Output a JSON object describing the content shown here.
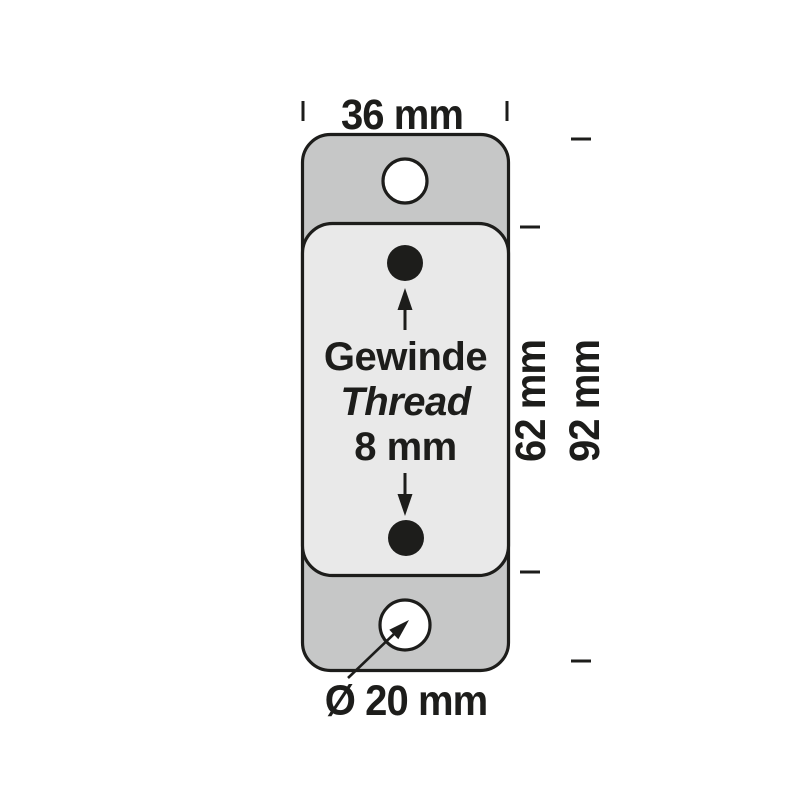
{
  "diagram": {
    "dimension_labels": {
      "width": "36 mm",
      "inner_height": "62 mm",
      "outer_height": "92 mm",
      "hole_diameter": "Ø 20 mm"
    },
    "thread_note": {
      "line1_de": "Gewinde",
      "line2_en": "Thread",
      "line3_size": "8 mm"
    },
    "colors": {
      "plate_fill": "#c6c7c7",
      "panel_fill": "#e9e9e9",
      "hole_fill": "#ffffff",
      "outline": "#1d1d1b",
      "background": "#ffffff"
    }
  }
}
